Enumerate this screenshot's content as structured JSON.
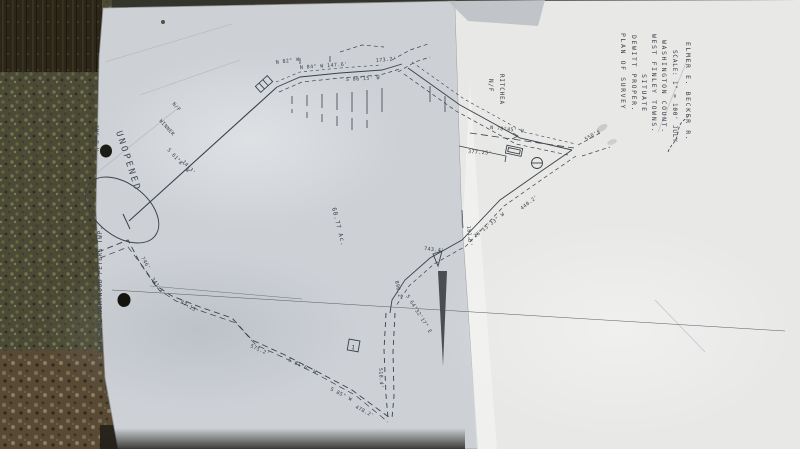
{
  "scene": {
    "ink_color": "#3b4148",
    "paper_left_color": "#cdd1d6",
    "paper_right_color": "#e8e8e7",
    "post_color": "#4c4a36",
    "gravel_color": "#5d4f3a"
  },
  "title_block": {
    "lines": [
      "PLAN OF SURVEY",
      "DEWITT  PROPER.",
      "SITUATE",
      "WEST FINLEY TOWNS.",
      "WASHINGTON COUNT.",
      "SCALE: 1\" = 100'  JULY",
      "ELMER E. BECKER  R."
    ]
  },
  "edge_text": {
    "fax_time": "JUL 21",
    "fax_id": "ING P.U",
    "recorder_stamp": "41246234Z NORTWOOD PETERS TWP."
  },
  "map_labels": {
    "unopened": "UNOPENED",
    "acreage": "68.77 Ac.",
    "winner_prefix": "N/F",
    "winner": "WINNER",
    "ritchea_prefix": "N/F",
    "ritchea": "RITCHEA",
    "monument1": "1"
  },
  "bearings": [
    {
      "text": "N 82° W"
    },
    {
      "text": "N 84° W  147.6'"
    },
    {
      "text": "S 86°15' W"
    },
    {
      "text": "173.2'"
    },
    {
      "text": "N 78°45' W"
    },
    {
      "text": "377.25'"
    },
    {
      "text": "550'±"
    },
    {
      "text": "181.5'"
    },
    {
      "text": "S 28°15'33\" W"
    },
    {
      "text": "440.2'"
    },
    {
      "text": "S 64°32'17\" E"
    },
    {
      "text": "890.2'"
    },
    {
      "text": "510.4'"
    },
    {
      "text": "478.2'"
    },
    {
      "text": "S 85° W"
    },
    {
      "text": "746'"
    },
    {
      "text": "341.1'"
    },
    {
      "text": "87.15'"
    },
    {
      "text": "575.2'"
    },
    {
      "text": "S 81°6' W"
    },
    {
      "text": "743.4'"
    },
    {
      "text": "S 61°8' W"
    },
    {
      "text": "1413'"
    }
  ]
}
